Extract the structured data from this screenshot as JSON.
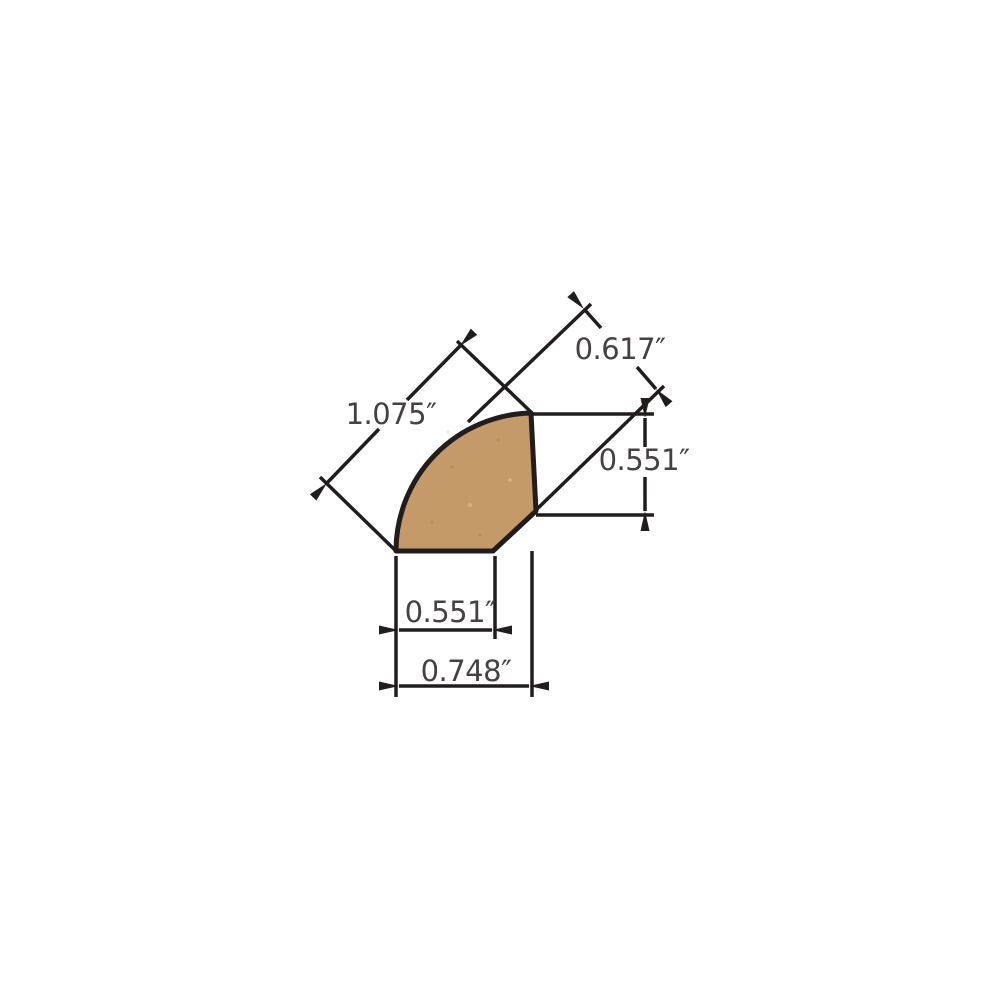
{
  "page": {
    "background_color": "#ffffff"
  },
  "diagram": {
    "kind": "molding-profile-dimension-drawing",
    "unit": "inches",
    "shape": {
      "name": "quarter-round-profile-cross-section",
      "fill_color": "#c49a69",
      "outline_color": "#211d1d"
    },
    "text_color": "#454142",
    "line_color": "#211d1d",
    "dimensions": {
      "diagonal_face": {
        "label": "1.075″",
        "value_inches": 1.075
      },
      "diagonal_projection": {
        "label": "0.617″",
        "value_inches": 0.617
      },
      "right_height": {
        "label": "0.551″",
        "value_inches": 0.551
      },
      "bottom_width": {
        "label": "0.551″",
        "value_inches": 0.551
      },
      "overall_width": {
        "label": "0.748″",
        "value_inches": 0.748
      }
    }
  }
}
